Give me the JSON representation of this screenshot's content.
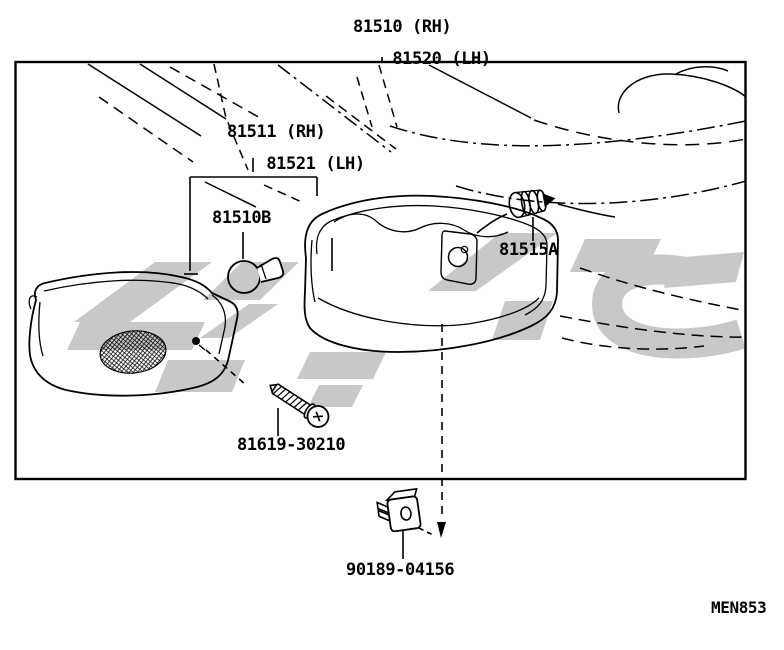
{
  "diagram": {
    "code": "MEN853",
    "labels": {
      "lamp_assy": {
        "line1": "81510 (RH)",
        "line2": "81520 (LH)"
      },
      "body_assy": {
        "line1": "81511 (RH)",
        "line2": "81521 (LH)"
      },
      "bulb": {
        "text": "81510B"
      },
      "socket": {
        "text": "81515A"
      },
      "screw": {
        "text": "81619-30210"
      },
      "clip": {
        "text": "90189-04156"
      }
    },
    "colors": {
      "line": "#000000",
      "watermark": "#c8c8c8",
      "background": "#ffffff"
    }
  }
}
